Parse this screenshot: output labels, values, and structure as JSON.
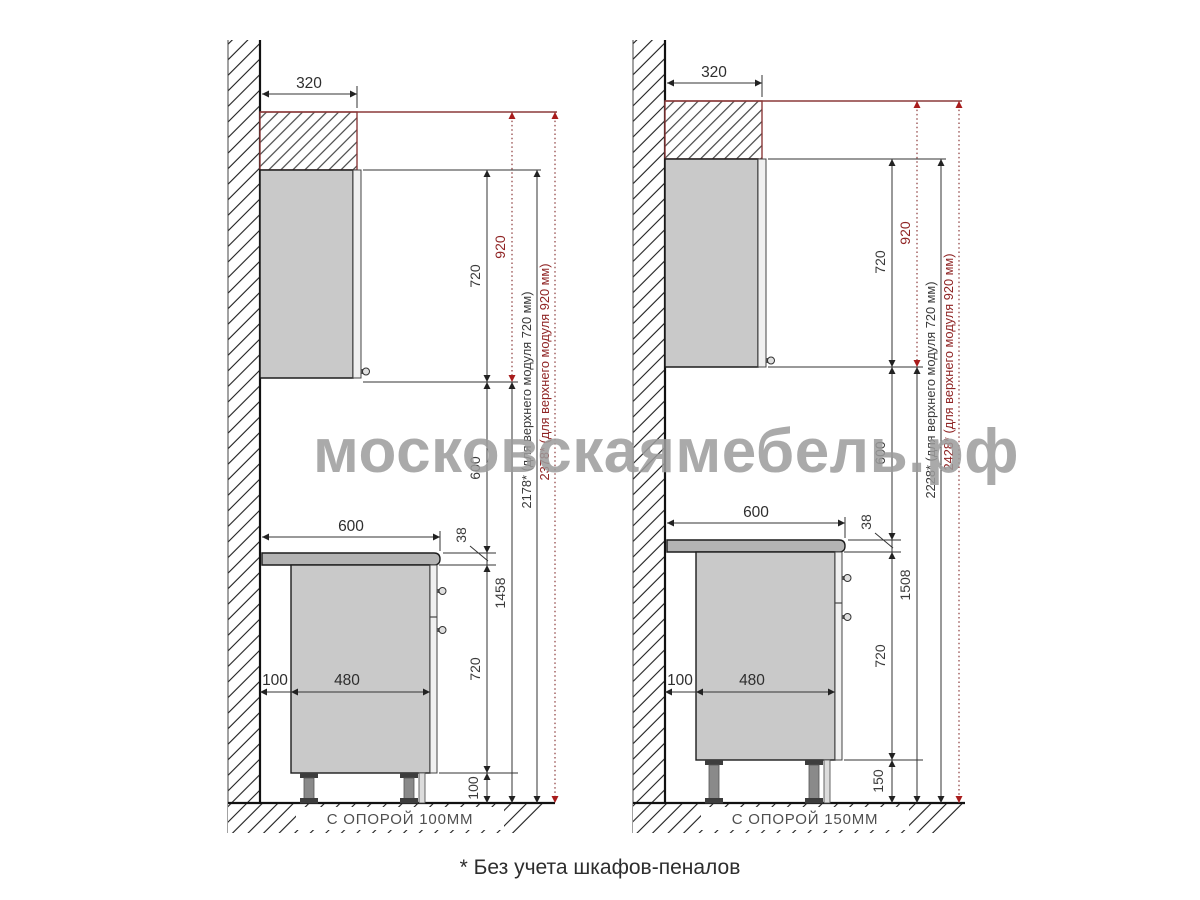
{
  "watermark": "московскаямебель.рф",
  "footnote": "* Без учета шкафов-пеналов",
  "colors": {
    "accent_red": "#8f2424",
    "red_arrow": "#a81c1c",
    "red_line": "#8b3a3a",
    "line": "#222222",
    "cabinet_fill": "#c9c9c9",
    "countertop_fill": "#b3b3b3",
    "watermark": "#9c9c9c"
  },
  "panels": {
    "left": {
      "support_label": "С ОПОРОЙ 100ММ",
      "dims": {
        "upper_depth": "320",
        "upper_module_720": "720",
        "upper_module_920": "920",
        "gap": "600",
        "countertop_thickness": "38",
        "base_module": "720",
        "legs": "100",
        "countertop_depth": "600",
        "wall_offset": "100",
        "base_depth": "480",
        "upper_bottom_height": "1458",
        "total_720": "2178* (для верхнего модуля 720 мм)",
        "total_920": "2378* (для верхнего модуля 920 мм)"
      }
    },
    "right": {
      "support_label": "С ОПОРОЙ 150ММ",
      "dims": {
        "upper_depth": "320",
        "upper_module_720": "720",
        "upper_module_920": "920",
        "gap": "600",
        "countertop_thickness": "38",
        "base_module": "720",
        "legs": "150",
        "countertop_depth": "600",
        "wall_offset": "100",
        "base_depth": "480",
        "upper_bottom_height": "1508",
        "total_720": "2228* (для верхнего модуля 720 мм)",
        "total_920": "2428* (для верхнего модуля 920 мм)"
      }
    }
  }
}
